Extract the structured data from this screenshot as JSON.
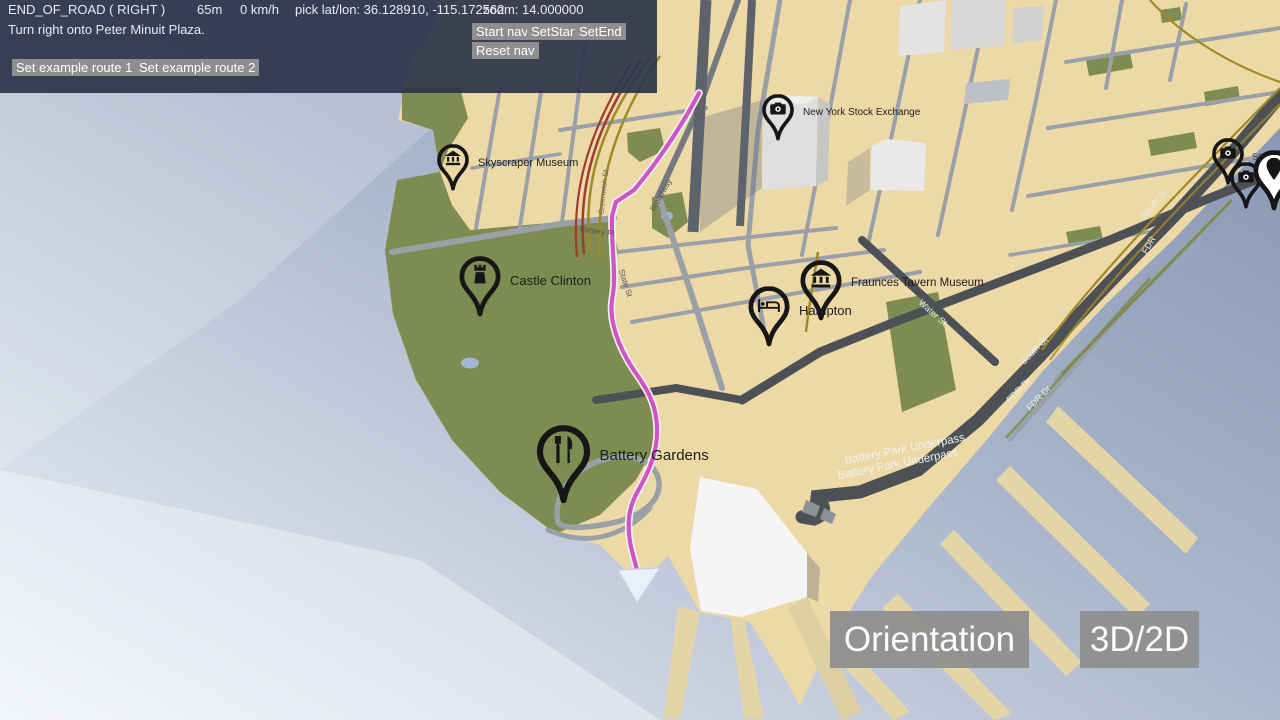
{
  "hud": {
    "maneuver": "END_OF_ROAD ( RIGHT )",
    "distance": "65m",
    "speed": "0 km/h",
    "pick": "pick lat/lon: 36.128910, -115.172562",
    "zoom": "zoom: 14.000000",
    "instruction": "Turn right onto Peter Minuit Plaza.",
    "nav_buttons": [
      {
        "label": "Start nav"
      },
      {
        "label": "SetStart"
      },
      {
        "label": "SetEnd"
      }
    ],
    "reset_label": "Reset nav",
    "route_buttons": [
      {
        "label": "Set example route 1"
      },
      {
        "label": "Set example route 2"
      }
    ]
  },
  "map_controls": {
    "orientation_label": "Orientation",
    "mode_label": "3D/2D"
  },
  "pois": [
    {
      "label": "Skyscraper Museum",
      "icon": "museum-icon",
      "x": 453,
      "y": 192,
      "size": "sm",
      "label_size": 11
    },
    {
      "label": "New York Stock Exchange",
      "icon": "camera-icon",
      "x": 778,
      "y": 142,
      "size": "sm",
      "label_size": 10
    },
    {
      "label": "Castle Clinton",
      "icon": "castle-icon",
      "x": 480,
      "y": 318,
      "size": "md",
      "label_size": 13
    },
    {
      "label": "Fraunces Tavern Museum",
      "icon": "museum-icon",
      "x": 821,
      "y": 322,
      "size": "md",
      "label_size": 11.5
    },
    {
      "label": "Hampton",
      "icon": "hotel-icon",
      "x": 769,
      "y": 348,
      "size": "md",
      "label_size": 13
    },
    {
      "label": "Battery Gardens",
      "icon": "restaurant-icon",
      "x": 563,
      "y": 505,
      "size": "lg",
      "label_size": 15
    },
    {
      "label": "",
      "icon": "camera-icon",
      "x": 1228,
      "y": 186,
      "size": "sm"
    },
    {
      "label": "",
      "icon": "camera-icon",
      "x": 1246,
      "y": 210,
      "size": "sm"
    },
    {
      "label": "",
      "icon": "pin-icon",
      "x": 1274,
      "y": 212,
      "size": "md",
      "fill": "#ffffff"
    }
  ],
  "road_labels": [
    {
      "text": "Battery Park Underpass",
      "x": 845,
      "y": 455,
      "rot": -11,
      "color": "#f0f0f0",
      "size": 11.5
    },
    {
      "text": "Battery Park Underpass",
      "x": 838,
      "y": 470,
      "rot": -11,
      "color": "#f0f0f0",
      "size": 11.5
    },
    {
      "text": "Water St",
      "x": 920,
      "y": 296,
      "rot": 42,
      "color": "#ececec",
      "size": 9
    },
    {
      "text": "South St",
      "x": 1022,
      "y": 358,
      "rot": -46,
      "color": "#ececec",
      "size": 9
    },
    {
      "text": "FDR Dr",
      "x": 1008,
      "y": 396,
      "rot": -46,
      "color": "#ececec",
      "size": 9
    },
    {
      "text": "FDR Dr",
      "x": 1028,
      "y": 404,
      "rot": -46,
      "color": "#ececec",
      "size": 9
    },
    {
      "text": "South St",
      "x": 1142,
      "y": 212,
      "rot": -48,
      "color": "#ececec",
      "size": 9
    },
    {
      "text": "FDR",
      "x": 1144,
      "y": 248,
      "rot": -60,
      "color": "#ececec",
      "size": 9
    },
    {
      "text": "Battery Pl",
      "x": 580,
      "y": 224,
      "rot": 9,
      "color": "#555555",
      "size": 8
    },
    {
      "text": "Broadway",
      "x": 652,
      "y": 206,
      "rot": -60,
      "color": "#555555",
      "size": 8
    },
    {
      "text": "State St",
      "x": 621,
      "y": 265,
      "rot": 72,
      "color": "#555555",
      "size": 8
    },
    {
      "text": "Greenwich St",
      "x": 601,
      "y": 210,
      "rot": -84,
      "color": "#6a6a6a",
      "size": 7.5
    },
    {
      "text": "South S",
      "x": 1252,
      "y": 152,
      "rot": -8,
      "color": "#333333",
      "size": 9
    }
  ],
  "colors": {
    "panel": "rgba(45,52,75,0.92)",
    "button": "#8e8e8e",
    "big_button": "rgba(141,141,141,0.92)",
    "water_deep": "#8291b0",
    "water_light": "#eef2f8",
    "land": "#ecd9a6",
    "park": "#7e8c52",
    "road": "#9aa0a8",
    "road_dark": "#4d5156",
    "route": "#cf55c4",
    "rail_yellow": "#a08a28",
    "rail_red": "#9e3c30",
    "building": "#dfdfdd",
    "pin": "#161616",
    "pond": "#9fb6d6"
  }
}
